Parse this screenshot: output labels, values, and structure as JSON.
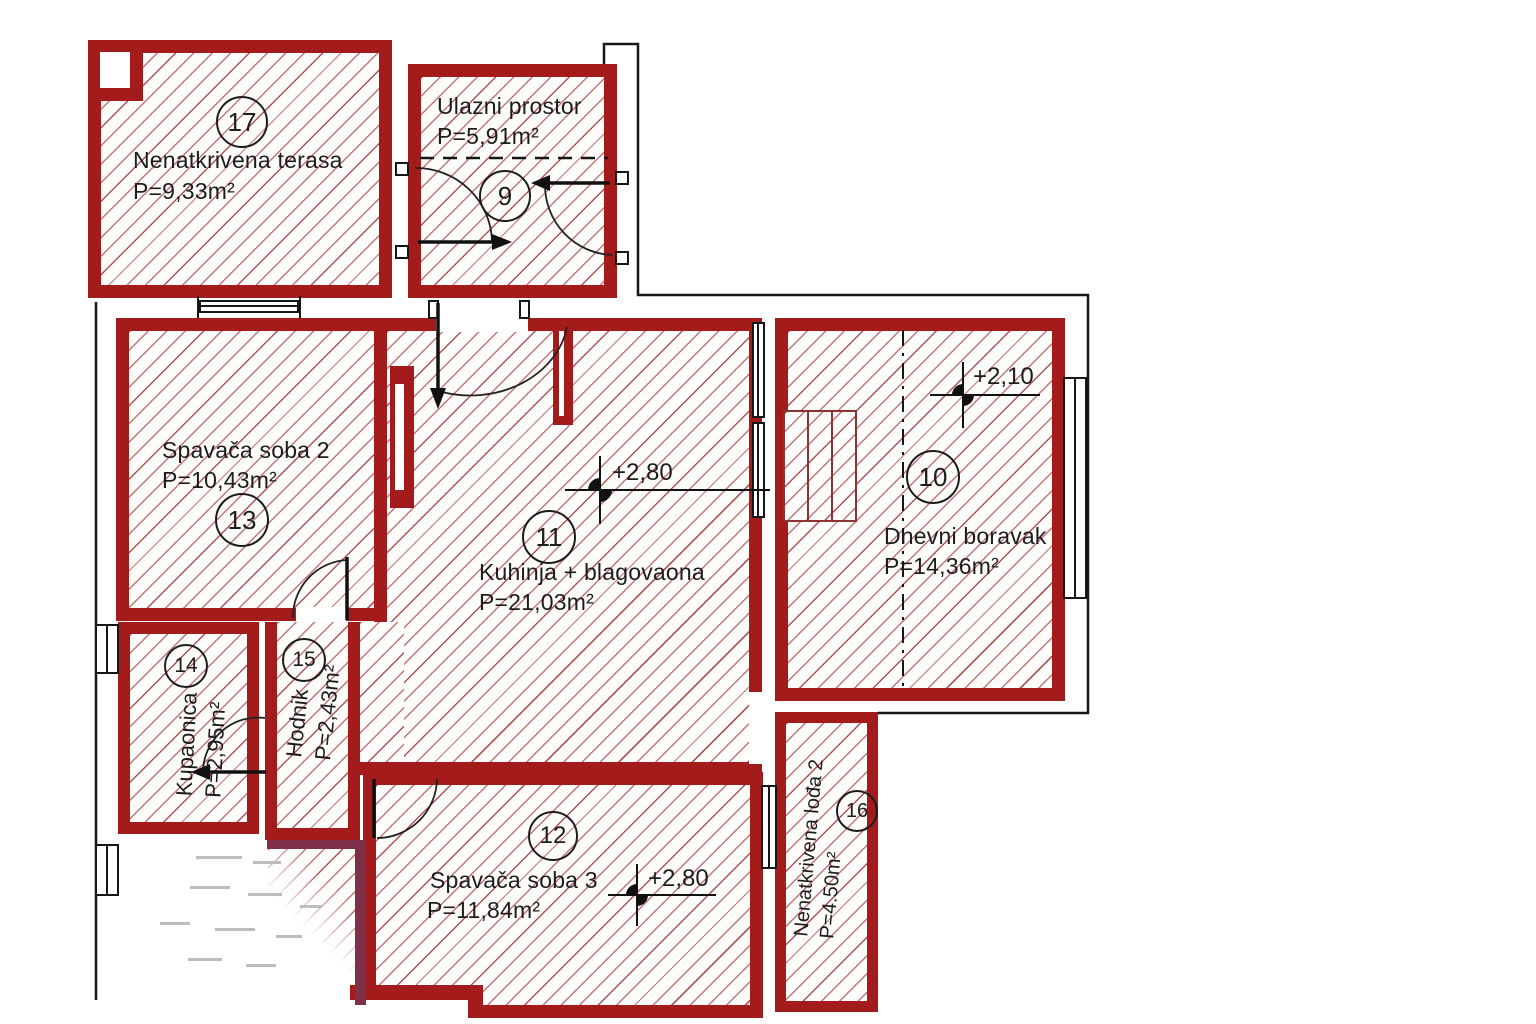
{
  "colors": {
    "wall": "#a31b1b",
    "hatch_line": "#a63e3e",
    "accent_wall": "#7d3048",
    "text": "#1d1d1d"
  },
  "rooms": [
    {
      "number": "17",
      "name": "Nenatkrivena terasa",
      "area": "P=9,33m²"
    },
    {
      "number": "9",
      "name": "Ulazni prostor",
      "area": "P=5,91m²"
    },
    {
      "number": "13",
      "name": "Spavača soba 2",
      "area": "P=10,43m²"
    },
    {
      "number": "11",
      "name": "Kuhinja + blagovaona",
      "area": "P=21,03m²"
    },
    {
      "number": "10",
      "name": "Dnevni boravak",
      "area": "P=14,36m²"
    },
    {
      "number": "14",
      "name": "Kupaonica",
      "area": "P=2,95m²"
    },
    {
      "number": "15",
      "name": "Hodnik",
      "area": "P=2,43m²"
    },
    {
      "number": "12",
      "name": "Spavača soba 3",
      "area": "P=11,84m²"
    },
    {
      "number": "16",
      "name": "Nenatkrivena lođa 2",
      "area": "P=4.50m²"
    }
  ],
  "levels": {
    "kitchen_dining": "+2,80",
    "living_room": "+2,10",
    "bedroom_3": "+2,80"
  }
}
